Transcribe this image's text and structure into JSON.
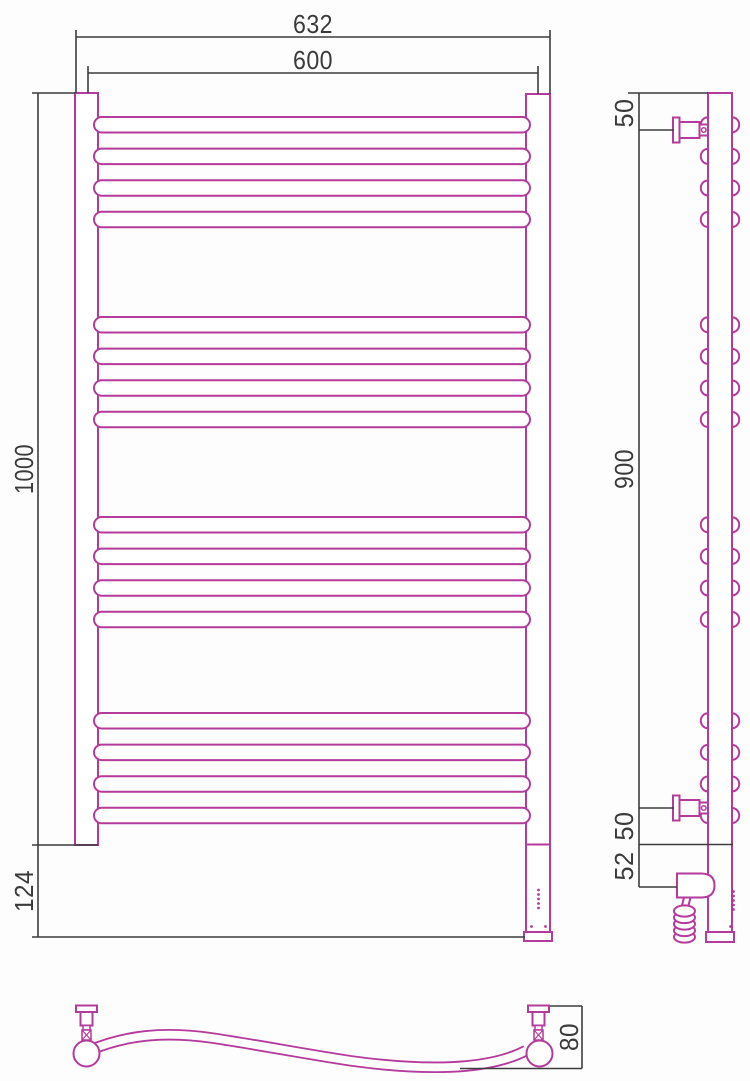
{
  "title": "heated-towel-rail-technical-drawing",
  "colors": {
    "product": "#b43a9c",
    "dimension": "#3d3d3d",
    "background": "#fdfdfd"
  },
  "front_view": {
    "width_overall": "632",
    "width_centers": "600",
    "height_body": "1000",
    "height_below": "124"
  },
  "side_view": {
    "top_mount_offset": "50",
    "mount_span": "900",
    "bottom_mount_offset": "50",
    "heater_offset": "52"
  },
  "plan_view": {
    "depth": "80"
  }
}
